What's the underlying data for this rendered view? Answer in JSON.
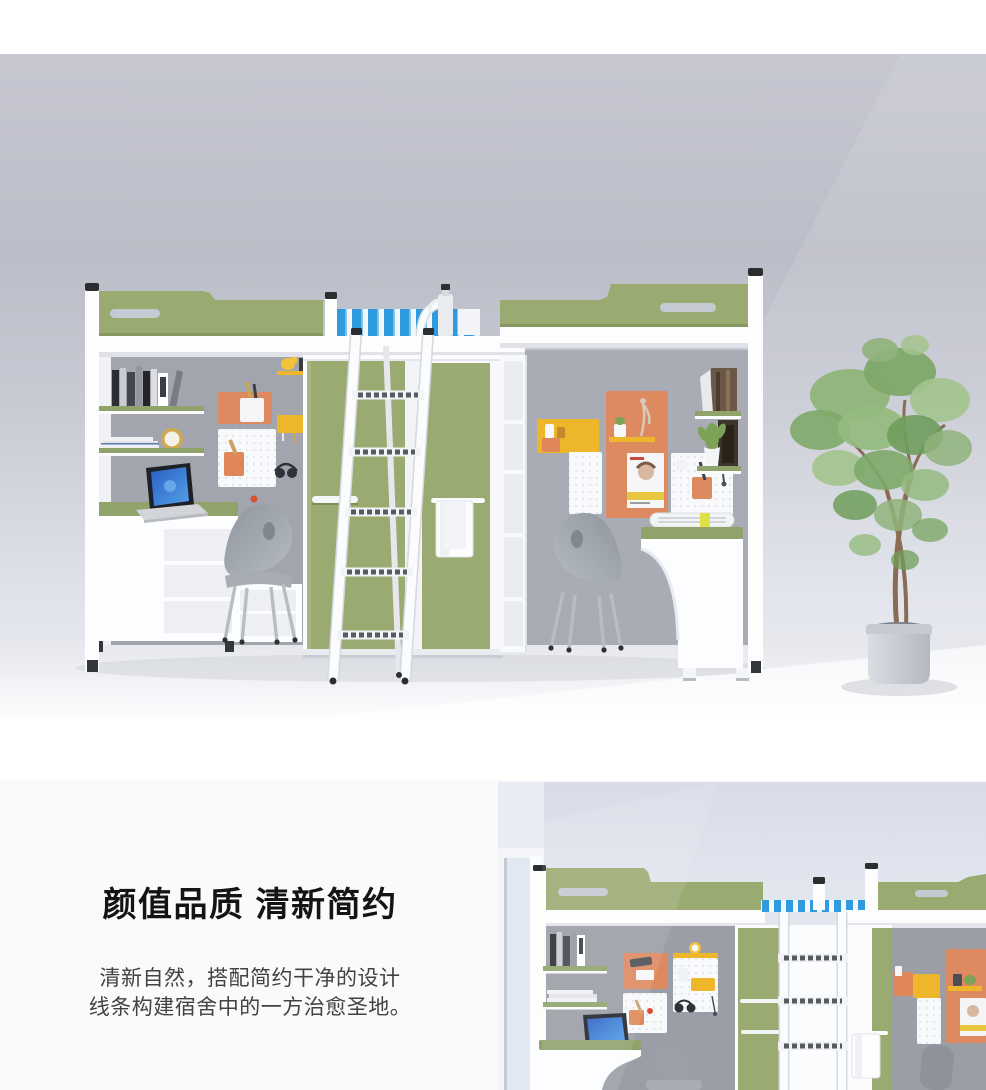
{
  "feature": {
    "title": "颜值品质 清新简约",
    "description_lines": [
      "清新自然，搭配简约干净的设计",
      "线条构建宿舍中的一方治愈圣地。"
    ]
  },
  "palette": {
    "accent_green": "#9aab72",
    "accent_orange": "#dd8a60",
    "accent_yellow": "#eeb62b",
    "wall_gray": "#c3c4ce",
    "nook_gray": "#a0a3ab",
    "section_bg": "#fafafa"
  }
}
